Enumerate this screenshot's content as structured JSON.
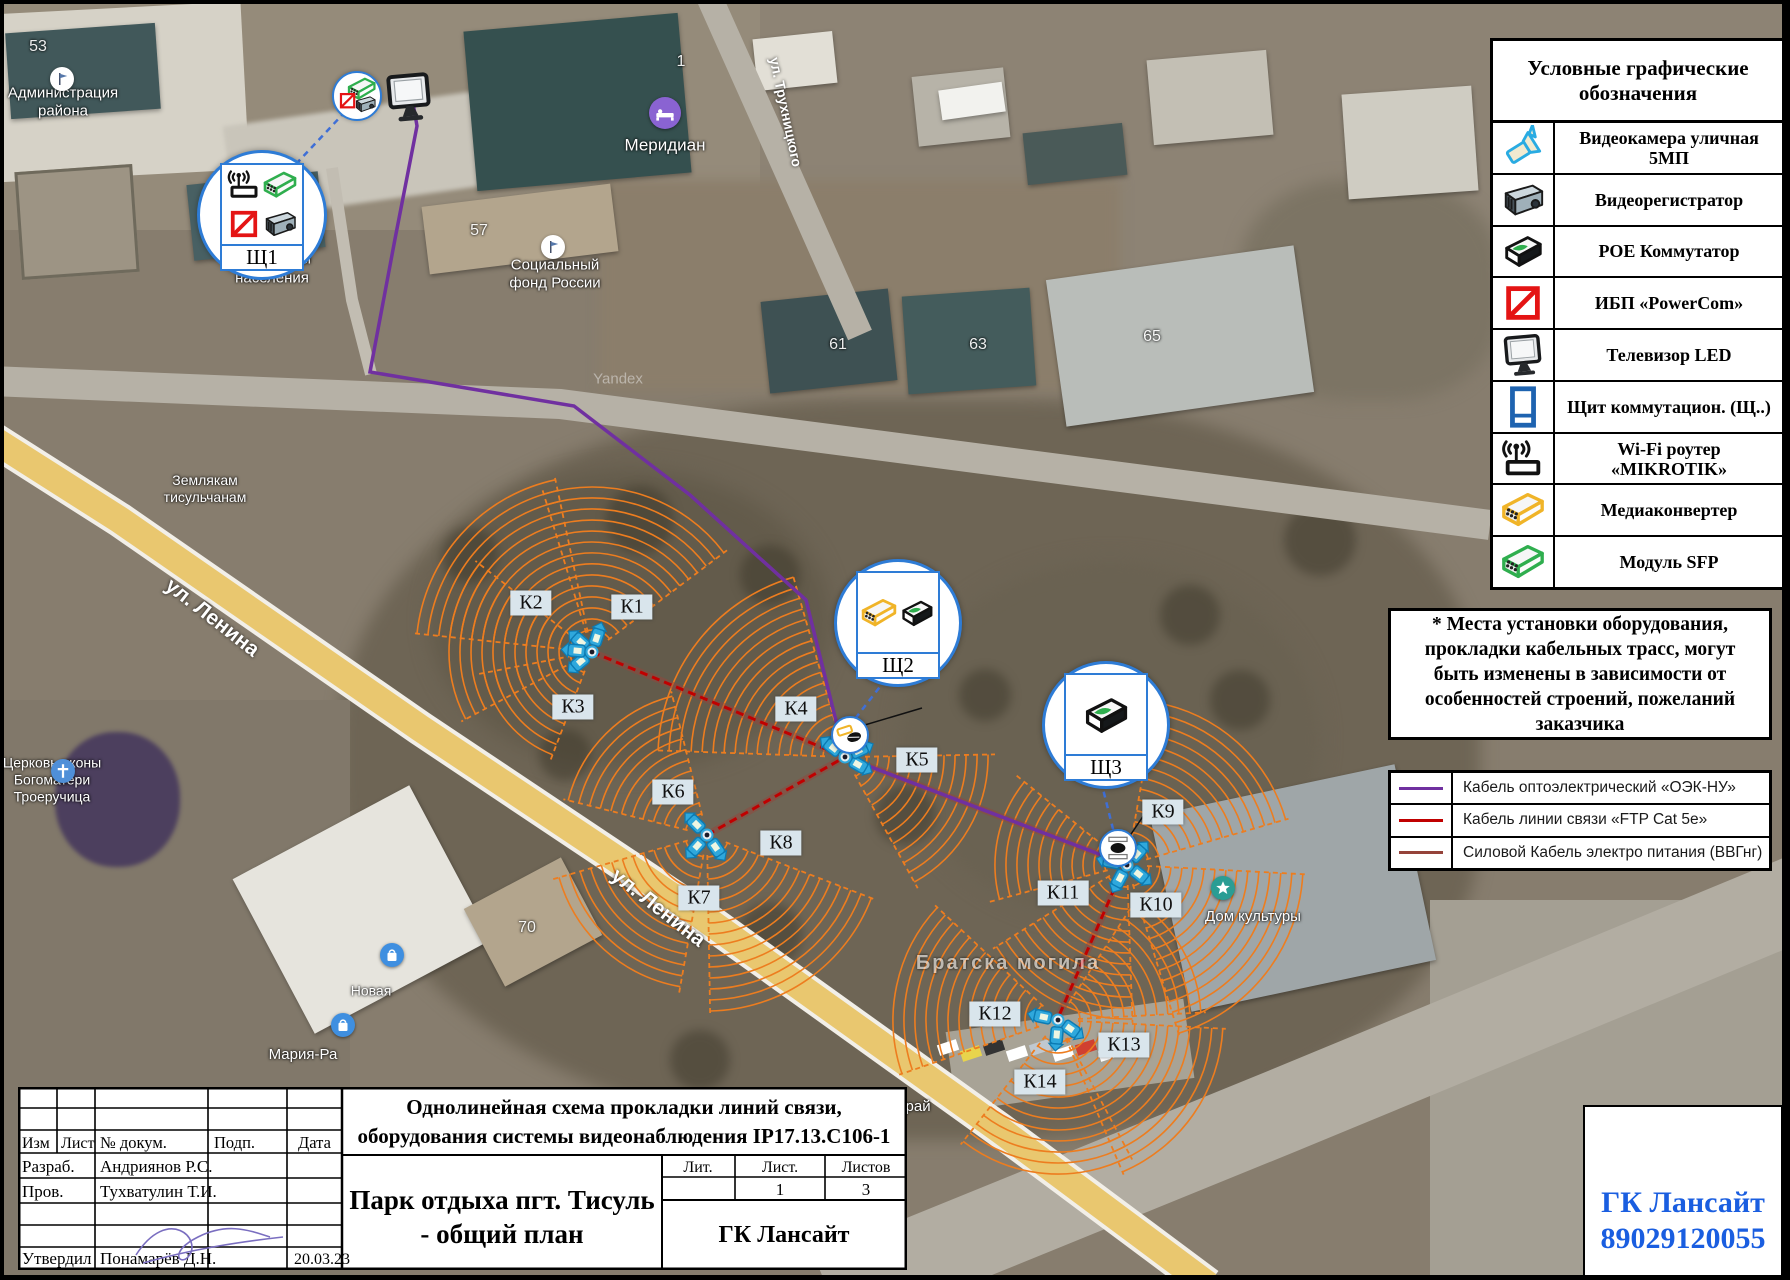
{
  "legend": {
    "title": "Условные графические обозначения",
    "rows": [
      {
        "icon": "camera-icon",
        "label": "Видеокамера уличная 5МП"
      },
      {
        "icon": "dvr-icon",
        "label": "Видеорегистратор"
      },
      {
        "icon": "poe-switch-icon",
        "label": "РОЕ Коммутатор"
      },
      {
        "icon": "ups-icon",
        "label": "ИБП «PowerCom»"
      },
      {
        "icon": "tv-icon",
        "label": "Телевизор LED"
      },
      {
        "icon": "panel-icon",
        "label": "Щит коммутацион. (Щ..)"
      },
      {
        "icon": "wifi-router-icon",
        "label": "Wi-Fi роутер «MIKROTIK»"
      },
      {
        "icon": "media-converter-icon",
        "label": "Медиаконвертер"
      },
      {
        "icon": "sfp-icon",
        "label": "Модуль SFP"
      }
    ]
  },
  "note": {
    "text": "* Места установки оборудования, прокладки кабельных трасс, могут быть изменены в зависимости от особенностей строений, пожеланий заказчика"
  },
  "cable_legend": {
    "rows": [
      {
        "color": "#7030a0",
        "label": "Кабель оптоэлектрический «ОЭК-НУ»"
      },
      {
        "color": "#c00000",
        "label": "Кабель линии связи «FTP Cat 5e»"
      },
      {
        "color": "#95433a",
        "label": "Силовой Кабель электро питания (ВВГнг)"
      }
    ]
  },
  "cameras": [
    {
      "id": "К1",
      "x": 632,
      "y": 607
    },
    {
      "id": "К2",
      "x": 531,
      "y": 603
    },
    {
      "id": "К3",
      "x": 573,
      "y": 707
    },
    {
      "id": "К4",
      "x": 796,
      "y": 709
    },
    {
      "id": "К5",
      "x": 917,
      "y": 760
    },
    {
      "id": "К6",
      "x": 673,
      "y": 792
    },
    {
      "id": "К7",
      "x": 699,
      "y": 898
    },
    {
      "id": "К8",
      "x": 781,
      "y": 843
    },
    {
      "id": "К9",
      "x": 1163,
      "y": 812
    },
    {
      "id": "К10",
      "x": 1156,
      "y": 905
    },
    {
      "id": "К11",
      "x": 1063,
      "y": 893
    },
    {
      "id": "К12",
      "x": 995,
      "y": 1014
    },
    {
      "id": "К13",
      "x": 1124,
      "y": 1045
    },
    {
      "id": "К14",
      "x": 1040,
      "y": 1082
    }
  ],
  "panels": [
    {
      "id": "Щ1",
      "x": 259,
      "y": 212,
      "r": 62,
      "icons": [
        "wifi-router-icon",
        "sfp-icon",
        "ups-icon",
        "dvr-icon"
      ]
    },
    {
      "id": "Щ2",
      "x": 895,
      "y": 620,
      "r": 61,
      "icons": [
        "media-converter-icon",
        "poe-switch-icon"
      ]
    },
    {
      "id": "Щ3",
      "x": 1103,
      "y": 722,
      "r": 61,
      "icons": [
        "poe-switch-icon"
      ]
    }
  ],
  "mini_markers": [
    {
      "kind": "equipment-cluster",
      "x": 355,
      "y": 94,
      "r": 23
    },
    {
      "kind": "poe-drop",
      "x": 848,
      "y": 733,
      "r": 17
    },
    {
      "kind": "poe-drop2",
      "x": 1116,
      "y": 846,
      "r": 17
    }
  ],
  "tv": {
    "x": 409,
    "y": 97
  },
  "nodes": [
    {
      "id": "A",
      "x": 592,
      "y": 652,
      "fans": [
        {
          "d": -72,
          "s": 70,
          "r": 170
        },
        {
          "d": -138,
          "s": 72,
          "r": 178
        },
        {
          "d": 185,
          "s": 66,
          "r": 148
        },
        {
          "d": 140,
          "s": 58,
          "r": 115
        }
      ],
      "cams": [
        -72,
        -138,
        140,
        185
      ]
    },
    {
      "id": "B",
      "x": 845,
      "y": 757,
      "fans": [
        {
          "d": -142,
          "s": 72,
          "r": 188
        },
        {
          "d": 30,
          "s": 62,
          "r": 150
        }
      ],
      "cams": [
        -142,
        30,
        -25
      ]
    },
    {
      "id": "C",
      "x": 707,
      "y": 835,
      "fans": [
        {
          "d": -135,
          "s": 62,
          "r": 148
        },
        {
          "d": 132,
          "s": 64,
          "r": 160
        },
        {
          "d": 55,
          "s": 68,
          "r": 182
        }
      ],
      "cams": [
        -135,
        132,
        55
      ]
    },
    {
      "id": "D",
      "x": 1127,
      "y": 865,
      "fans": [
        {
          "d": -48,
          "s": 64,
          "r": 168
        },
        {
          "d": 38,
          "s": 70,
          "r": 182
        },
        {
          "d": 118,
          "s": 60,
          "r": 158
        },
        {
          "d": -168,
          "s": 54,
          "r": 142
        }
      ],
      "cams": [
        -48,
        38,
        118,
        -168
      ]
    },
    {
      "id": "E",
      "x": 1058,
      "y": 1020,
      "fans": [
        {
          "d": -168,
          "s": 62,
          "r": 168
        },
        {
          "d": -30,
          "s": 54,
          "r": 148
        },
        {
          "d": 35,
          "s": 64,
          "r": 168
        },
        {
          "d": 95,
          "s": 66,
          "r": 158
        }
      ],
      "cams": [
        -168,
        35,
        95
      ]
    }
  ],
  "cables": {
    "optic": [
      [
        412,
        97
      ],
      [
        417,
        126
      ],
      [
        395,
        239
      ],
      [
        370,
        372
      ],
      [
        574,
        406
      ],
      [
        690,
        495
      ],
      [
        806,
        600
      ],
      [
        845,
        757
      ],
      [
        1125,
        864
      ]
    ],
    "ftp": [
      [
        [
          592,
          652
        ],
        [
          845,
          757
        ]
      ],
      [
        [
          707,
          835
        ],
        [
          845,
          757
        ]
      ],
      [
        [
          845,
          757
        ],
        [
          1125,
          864
        ]
      ],
      [
        [
          1125,
          864
        ],
        [
          1058,
          1018
        ]
      ]
    ],
    "power": [
      [
        [
          592,
          652
        ],
        [
          845,
          757
        ],
        [
          1125,
          864
        ],
        [
          1058,
          1018
        ]
      ],
      [
        [
          845,
          757
        ],
        [
          707,
          835
        ]
      ]
    ],
    "drops": [
      [
        [
          296,
          164
        ],
        [
          344,
          113
        ]
      ],
      [
        [
          886,
          679
        ],
        [
          851,
          724
        ]
      ],
      [
        [
          1101,
          781
        ],
        [
          1114,
          833
        ]
      ]
    ],
    "leaders": [
      [
        [
          1146,
          812
        ],
        [
          1123,
          846
        ]
      ],
      [
        [
          858,
          727
        ],
        [
          922,
          708
        ]
      ],
      [
        [
          1137,
          716
        ],
        [
          1162,
          711
        ]
      ]
    ]
  },
  "map_labels": {
    "streets": [
      {
        "text": "ул. Ленина",
        "x": 212,
        "y": 618,
        "rot": 38,
        "size": 21
      },
      {
        "text": "ул. Ленина",
        "x": 658,
        "y": 908,
        "rot": 38,
        "size": 21
      },
      {
        "text": "ул. Трухницкого",
        "x": 786,
        "y": 112,
        "rot": 78,
        "size": 14
      }
    ],
    "places": [
      {
        "text": "Администрация\nрайона",
        "x": 63,
        "y": 103,
        "size": 15
      },
      {
        "text": "Меридиан",
        "x": 665,
        "y": 146,
        "size": 17
      },
      {
        "text": "Управление\nсоцзащиты\nнаселения",
        "x": 272,
        "y": 260,
        "size": 15
      },
      {
        "text": "Социальный\nфонд России",
        "x": 555,
        "y": 275,
        "size": 15
      },
      {
        "text": "Землякам\nтисульчанам",
        "x": 205,
        "y": 489,
        "size": 14
      },
      {
        "text": "Церковь иконы\nБогоматери\nТроеручица",
        "x": 52,
        "y": 780,
        "size": 14
      },
      {
        "text": "Новая",
        "x": 371,
        "y": 991,
        "size": 14
      },
      {
        "text": "Мария-Ра",
        "x": 303,
        "y": 1055,
        "size": 15
      },
      {
        "text": "Дом культуры",
        "x": 1253,
        "y": 917,
        "size": 15
      },
      {
        "text": "Фруктовый рай",
        "x": 878,
        "y": 1107,
        "size": 15
      },
      {
        "text": "Братска  могила",
        "x": 1008,
        "y": 963,
        "size": 20,
        "faded": true
      }
    ],
    "numbers": [
      {
        "text": "53",
        "x": 38,
        "y": 47
      },
      {
        "text": "1",
        "x": 681,
        "y": 62
      },
      {
        "text": "57",
        "x": 479,
        "y": 231
      },
      {
        "text": "61",
        "x": 838,
        "y": 345
      },
      {
        "text": "63",
        "x": 978,
        "y": 345
      },
      {
        "text": "65",
        "x": 1152,
        "y": 337
      },
      {
        "text": "70",
        "x": 527,
        "y": 928
      }
    ],
    "watermark": {
      "text": "Yandex",
      "x": 618,
      "y": 379
    }
  },
  "pois": [
    {
      "type": "flag",
      "x": 62,
      "y": 79,
      "color": "#ffffff"
    },
    {
      "type": "bed",
      "x": 665,
      "y": 113,
      "color": "#8a63d2"
    },
    {
      "type": "flag",
      "x": 553,
      "y": 247,
      "color": "#ffffff"
    },
    {
      "type": "cross",
      "x": 63,
      "y": 771,
      "color": "#4f8fd8"
    },
    {
      "type": "bag",
      "x": 392,
      "y": 955,
      "color": "#3f8fe0"
    },
    {
      "type": "bag",
      "x": 343,
      "y": 1025,
      "color": "#3f8fe0"
    },
    {
      "type": "culture",
      "x": 1223,
      "y": 888,
      "color": "#2a9d94"
    }
  ],
  "title_block": {
    "cols": [
      "Изм",
      "Лист",
      "№ докум.",
      "Подп.",
      "Дата"
    ],
    "rows": [
      {
        "role": "Разраб.",
        "name": "Андриянов Р.С.",
        "date": ""
      },
      {
        "role": "Пров.",
        "name": "Тухватулин Т.И.",
        "date": ""
      },
      {
        "role": "",
        "name": "",
        "date": ""
      },
      {
        "role": "",
        "name": "",
        "date": ""
      },
      {
        "role": "Утвердил",
        "name": "Понамарёв Д.Н.",
        "date": "20.03.23"
      }
    ],
    "doc_title_line1": "Однолинейная схема прокладки линий связи,",
    "doc_title_line2": "оборудования системы видеонаблюдения IP17.13.С106-1",
    "object_line1": "Парк отдыха пгт. Тисуль",
    "object_line2": "- общий план",
    "lit_cols": [
      "Лит.",
      "Лист.",
      "Листов"
    ],
    "lit_values": [
      "",
      "1",
      "3"
    ],
    "company": "ГК Лансайт"
  },
  "contact": {
    "line1": "ГК Лансайт",
    "line2": "89029120055",
    "color": "#1a5ee0"
  }
}
